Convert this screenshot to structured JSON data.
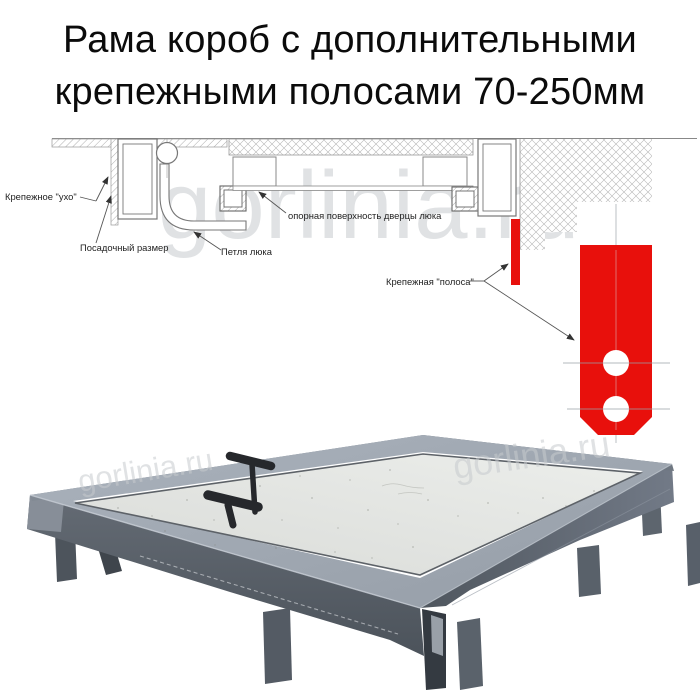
{
  "title": {
    "line1": "Рама короб с дополнительными",
    "line2": "крепежными полосами 70-250мм"
  },
  "diagram": {
    "labels": {
      "ear": "Крепежное \"ухо\"",
      "seat_size": "Посадочный размер",
      "hinge": "Петля люка",
      "support_surface": "опорная поверхность дверцы люка",
      "strip": "Крепежная \"полоса\""
    }
  },
  "watermark": {
    "text": "gorlinia.ru"
  },
  "colors": {
    "accent_red": "#e8100c",
    "metal_dark": "#565d66",
    "metal_mid": "#6a7280",
    "metal_light": "#a0a8b2",
    "panel": "#e3e4e2",
    "drawing_line": "#888888",
    "label_text": "#222222"
  }
}
